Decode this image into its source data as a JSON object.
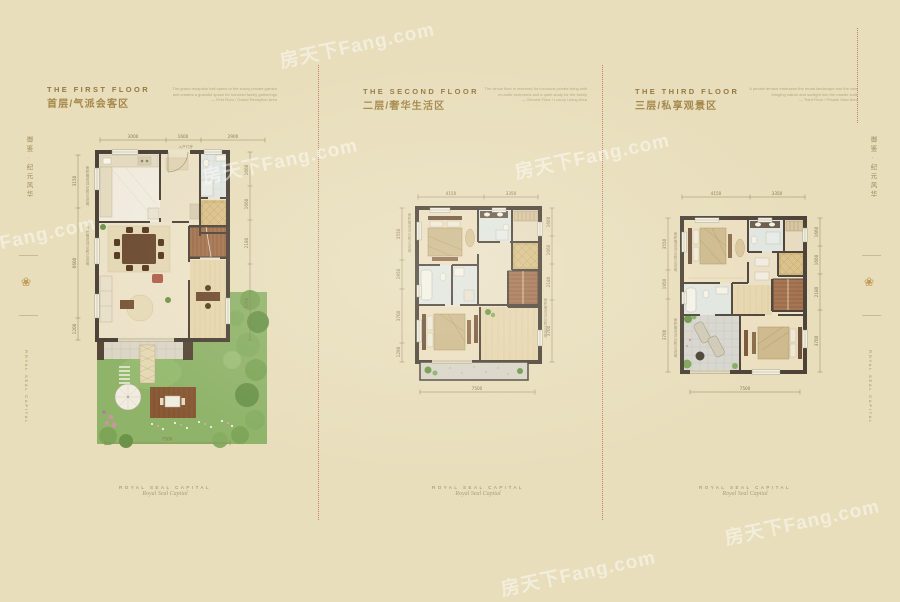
{
  "page": {
    "bg_color": "#e8debc",
    "accent_red": "#b2553e",
    "title_color": "#96783f",
    "subtitle_color": "#a5874b",
    "dim_color": "#8a7a52",
    "wall_color": "#4c4238",
    "garden_green": "#8fb369",
    "stair_brown": "#a5734f",
    "tile_gold": "#d9c189",
    "watermark_text": "房天下Fang.com",
    "side_note": "面积赠送详见附注说明"
  },
  "edges": {
    "vertical_cn": "御鉴·纪元风华",
    "vertical_en": "ROYAL SEAL CAPITAL"
  },
  "panels": [
    {
      "id": "first-floor",
      "title_en": "THE FIRST FLOOR",
      "title_cn": "首层/气派会客区",
      "fine_print": [
        "The grand reception hall opens to the sunny private garden",
        "and creates a graceful space for honored family gatherings",
        "— First Floor / Grand Reception Area"
      ],
      "entry_label": "入户门厅",
      "dims": {
        "top": [
          "3000",
          "1600",
          "2900"
        ],
        "left": [
          "3150",
          "6600",
          "1200"
        ],
        "right": [
          "1660",
          "1660",
          "2180",
          "3700"
        ],
        "bottom": "7500"
      },
      "footer": {
        "caps": "ROYAL SEAL CAPITAL",
        "script": "Royal Seal Capital"
      }
    },
    {
      "id": "second-floor",
      "title_en": "THE SECOND FLOOR",
      "title_cn": "二层/奢华生活区",
      "fine_print": [
        "The whole floor is reserved for luxurious private living with",
        "en-suite bedrooms and a quiet study for the family",
        "— Second Floor / Luxury Living Area"
      ],
      "dims": {
        "top": [
          "4150",
          "3350"
        ],
        "left": [
          "3550",
          "1950",
          "3700",
          "1290"
        ],
        "right": [
          "1660",
          "1660",
          "2180",
          "3700"
        ],
        "bottom": "7500"
      },
      "footer": {
        "caps": "ROYAL SEAL CAPITAL",
        "script": "Royal Seal Capital"
      }
    },
    {
      "id": "third-floor",
      "title_en": "THE THIRD FLOOR",
      "title_cn": "三层/私享观景区",
      "fine_print": [
        "A private terrace embraces the broad landscape and the view",
        "bringing nature and sunlight into the master suite",
        "— Third Floor / Private View Area"
      ],
      "dims": {
        "top": [
          "4150",
          "3350"
        ],
        "left": [
          "3550",
          "1950",
          "3700"
        ],
        "right": [
          "1660",
          "1660",
          "2180",
          "3700"
        ],
        "bottom": "7500"
      },
      "footer": {
        "caps": "ROYAL SEAL CAPITAL",
        "script": "Royal Seal Capital"
      }
    }
  ]
}
